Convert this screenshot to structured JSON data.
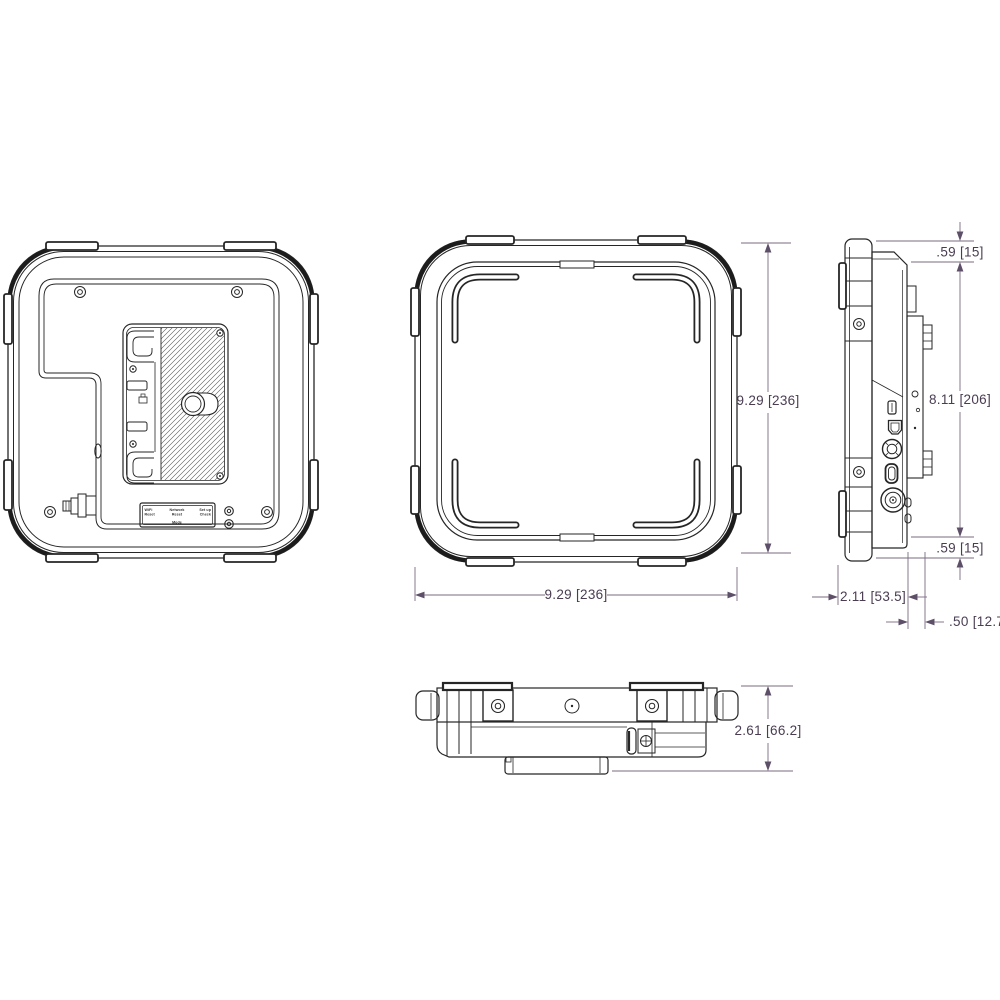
{
  "colors": {
    "background": "#ffffff",
    "line": "#262626",
    "bumper_thick": "#1c1c1c",
    "dim_line": "#7a6b80",
    "dim_arrow": "#5d4f68",
    "dim_text": "#4a3d52"
  },
  "views": {
    "rear": {
      "name": "rear view with battery plate",
      "label_plate": {
        "col1_line1": "WiFi",
        "col1_line2": "Reset",
        "col2_line1": "Network",
        "col2_line2": "Reset",
        "col3_line1": "Set up",
        "col3_line2": "Check",
        "footer": "Mode"
      }
    },
    "front": {
      "name": "front view",
      "dims": {
        "height": "9.29 [236]",
        "width": "9.29 [236]"
      }
    },
    "side": {
      "name": "side view",
      "dims": {
        "top": ".59 [15]",
        "mount": "8.11 [206]",
        "bottom": ".59 [15]",
        "depth": "2.11 [53.5]",
        "plate": ".50 [12.7]"
      }
    },
    "bottom": {
      "name": "bottom view",
      "dims": {
        "thickness": "2.61 [66.2]"
      }
    }
  }
}
